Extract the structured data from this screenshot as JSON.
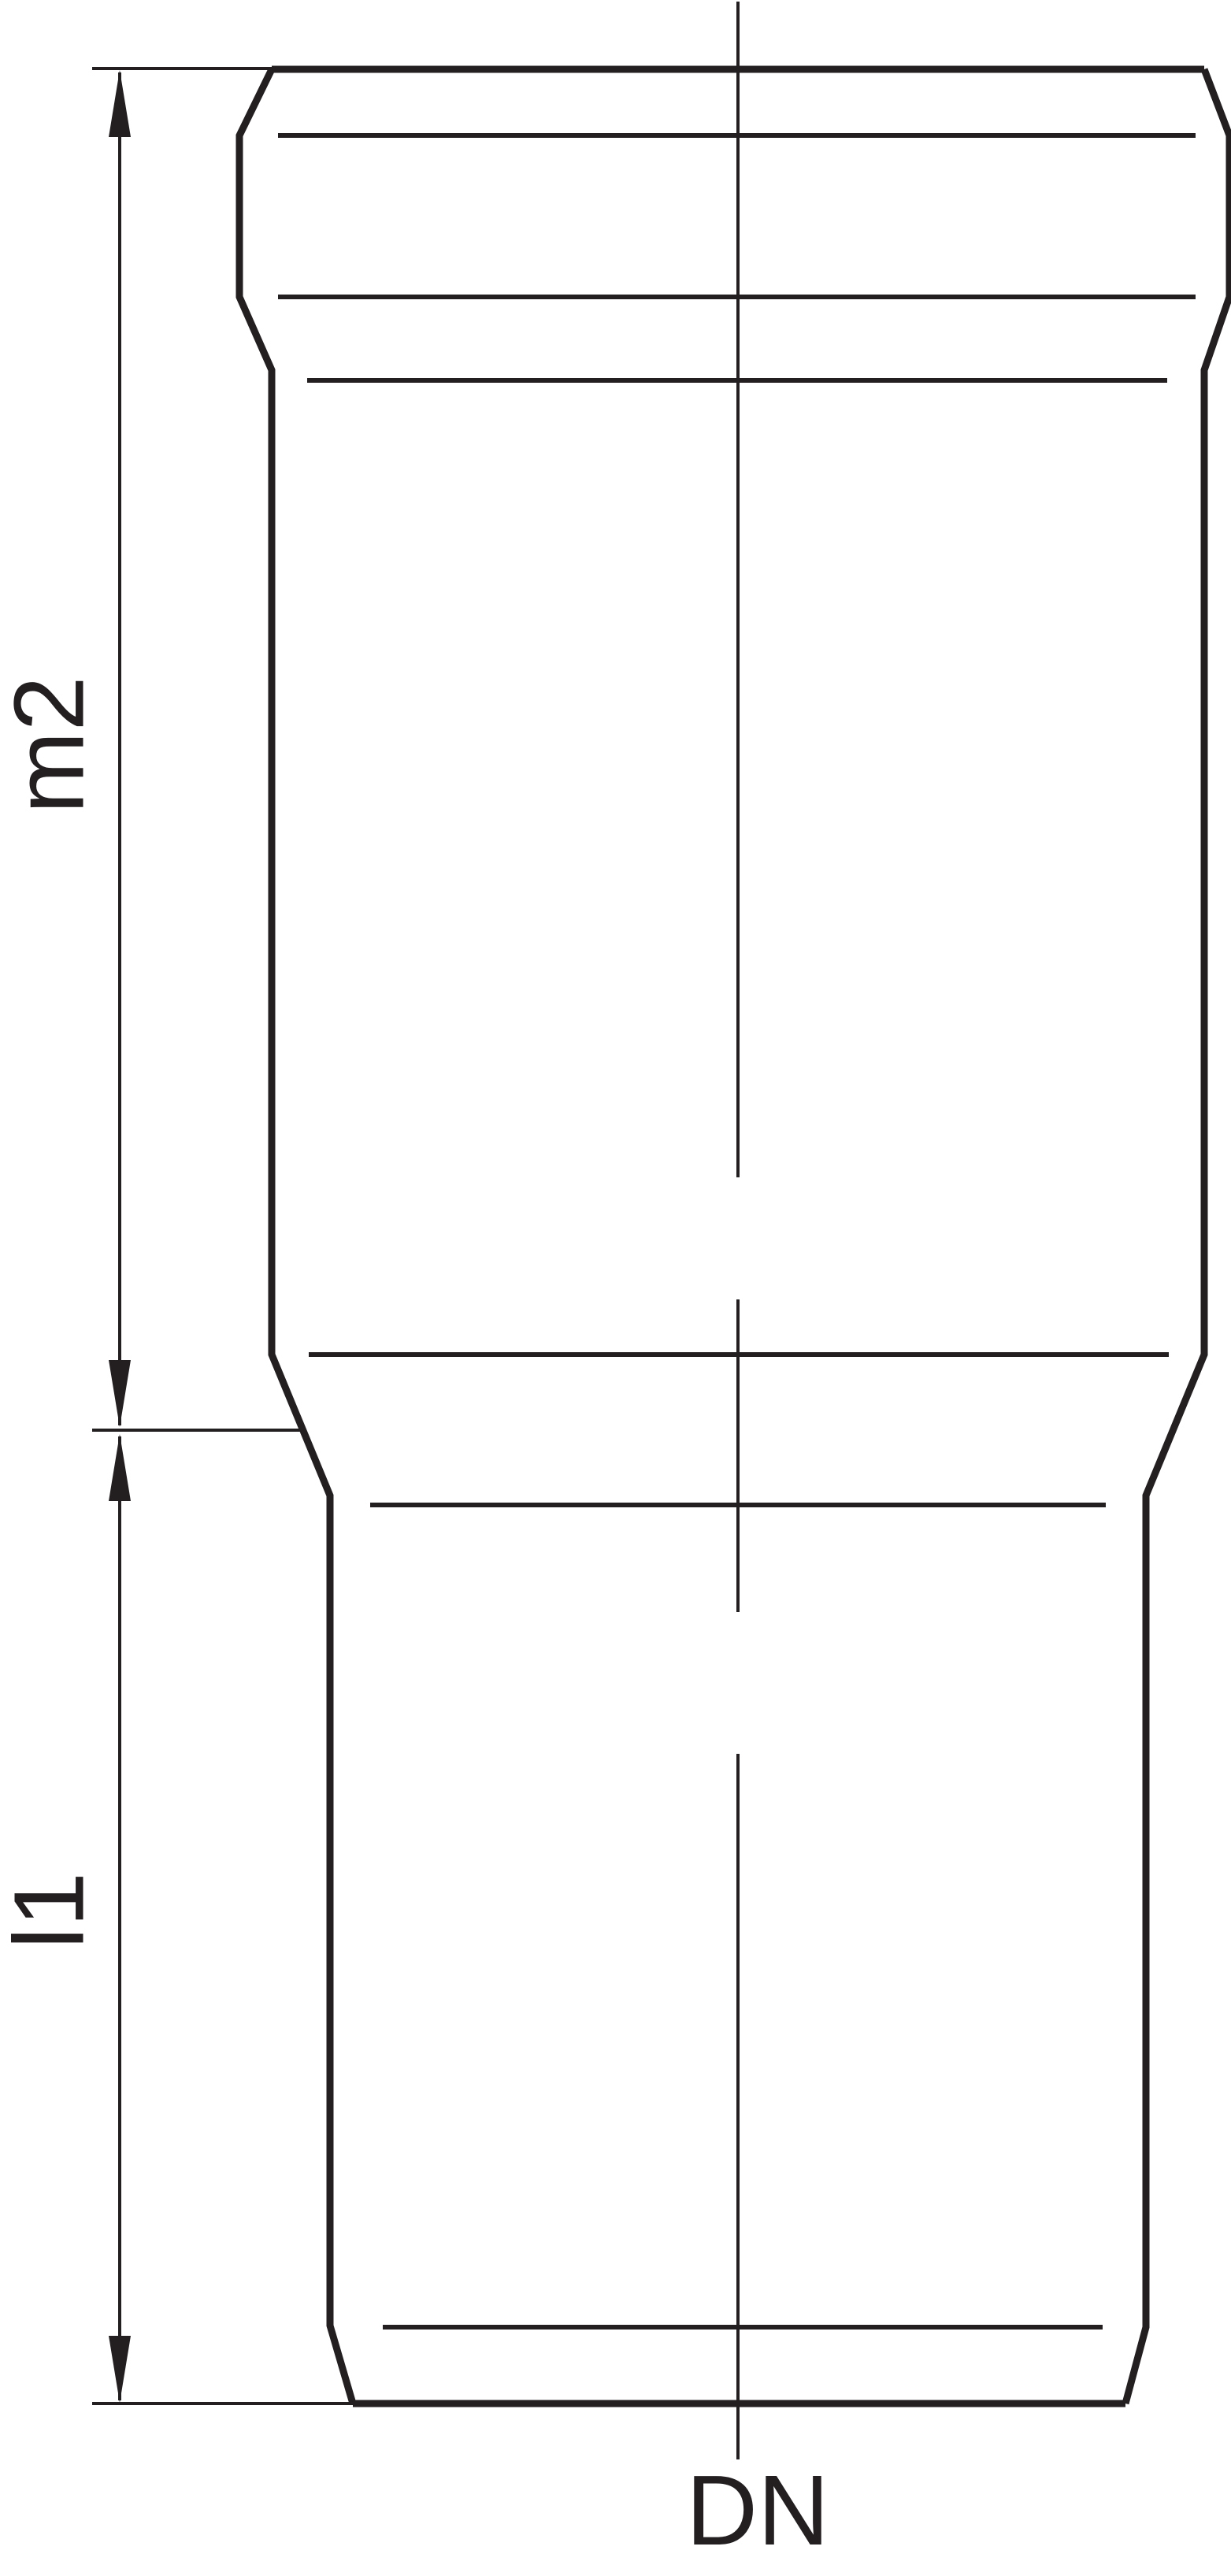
{
  "drawing": {
    "labels": {
      "dim_upper": "m2",
      "dim_lower": "l1",
      "diameter": "DN"
    },
    "colors": {
      "line": "#231f20",
      "background": "#ffffff"
    }
  }
}
